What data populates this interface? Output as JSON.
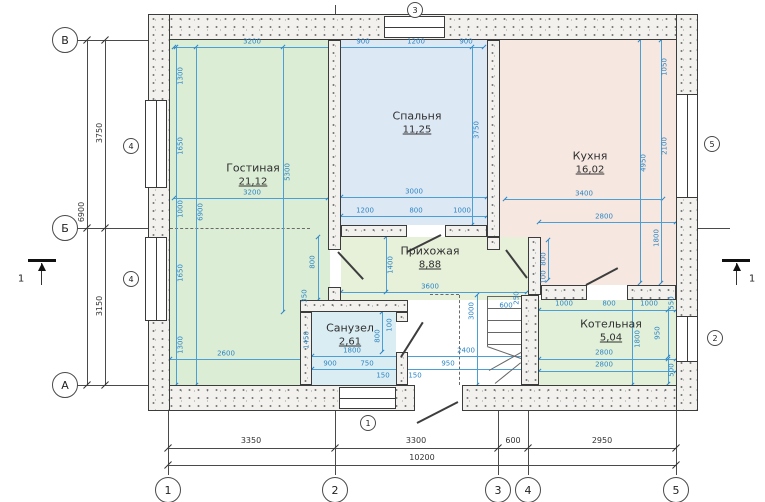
{
  "title": "floor-plan",
  "palette": {
    "dim_blue": "#2e86c4",
    "line_blue": "#4b9fd4",
    "ink": "#3a3a3a",
    "wall_fill": "#f2f1ed",
    "living": "#dcedd6",
    "bedroom": "#dde8f5",
    "kitchen": "#f6e7e0",
    "hall": "#e7f0d9",
    "bath": "#daedf3",
    "boiler": "#e2f0da"
  },
  "rooms": [
    {
      "id": "gostinaya",
      "name": "Гостиная",
      "area": "21,12",
      "color": "#dcedd6",
      "x": 170,
      "y": 40,
      "w": 160,
      "h": 345,
      "lx": 253,
      "ly": 168
    },
    {
      "id": "spalnya",
      "name": "Спальня",
      "area": "11,25",
      "color": "#dde8f5",
      "x": 341,
      "y": 40,
      "w": 146,
      "h": 185,
      "lx": 417,
      "ly": 116
    },
    {
      "id": "kuhnya",
      "name": "Кухня",
      "area": "16,02",
      "color": "#f6e7e0",
      "x": 500,
      "y": 40,
      "w": 176,
      "h": 245,
      "lx": 590,
      "ly": 156
    },
    {
      "id": "prihozhaya",
      "name": "Прихожая",
      "area": "8,88",
      "color": "#e7f0d9",
      "x": 341,
      "y": 237,
      "w": 187,
      "h": 63,
      "lx": 430,
      "ly": 251
    },
    {
      "id": "sanuzel",
      "name": "Санузел",
      "area": "2,61",
      "color": "#daedf3",
      "x": 312,
      "y": 312,
      "w": 84,
      "h": 73,
      "lx": 350,
      "ly": 328
    },
    {
      "id": "kotelnaya",
      "name": "Котельная",
      "area": "5,04",
      "color": "#e2f0da",
      "x": 539,
      "y": 300,
      "w": 137,
      "h": 85,
      "lx": 611,
      "ly": 324
    }
  ],
  "walls": [
    {
      "x": 148,
      "y": 14,
      "w": 550,
      "h": 26
    },
    {
      "x": 148,
      "y": 385,
      "w": 267,
      "h": 26
    },
    {
      "x": 462,
      "y": 385,
      "w": 236,
      "h": 26
    },
    {
      "x": 148,
      "y": 14,
      "w": 22,
      "h": 397
    },
    {
      "x": 676,
      "y": 14,
      "w": 22,
      "h": 397
    },
    {
      "x": 328,
      "y": 40,
      "w": 13,
      "h": 210
    },
    {
      "x": 328,
      "y": 287,
      "w": 13,
      "h": 25
    },
    {
      "x": 341,
      "y": 225,
      "w": 66,
      "h": 12
    },
    {
      "x": 445,
      "y": 225,
      "w": 42,
      "h": 12
    },
    {
      "x": 487,
      "y": 40,
      "w": 13,
      "h": 197
    },
    {
      "x": 487,
      "y": 237,
      "w": 13,
      "h": 13
    },
    {
      "x": 528,
      "y": 237,
      "w": 13,
      "h": 58
    },
    {
      "x": 541,
      "y": 285,
      "w": 46,
      "h": 15
    },
    {
      "x": 627,
      "y": 285,
      "w": 49,
      "h": 15
    },
    {
      "x": 300,
      "y": 300,
      "w": 108,
      "h": 12
    },
    {
      "x": 300,
      "y": 312,
      "w": 12,
      "h": 73
    },
    {
      "x": 396,
      "y": 312,
      "w": 12,
      "h": 10
    },
    {
      "x": 396,
      "y": 352,
      "w": 12,
      "h": 33
    },
    {
      "x": 521,
      "y": 295,
      "w": 18,
      "h": 90
    }
  ],
  "windows": [
    {
      "x": 145,
      "y": 100,
      "w": 22,
      "h": 88,
      "o": "v"
    },
    {
      "x": 145,
      "y": 237,
      "w": 22,
      "h": 84,
      "o": "v"
    },
    {
      "x": 676,
      "y": 94,
      "w": 22,
      "h": 104,
      "o": "v"
    },
    {
      "x": 676,
      "y": 316,
      "w": 22,
      "h": 46,
      "o": "v"
    },
    {
      "x": 384,
      "y": 16,
      "w": 61,
      "h": 22,
      "o": "h"
    },
    {
      "x": 339,
      "y": 387,
      "w": 57,
      "h": 22,
      "o": "h"
    }
  ],
  "window_marks": [
    {
      "label": "4",
      "x": 131,
      "y": 146
    },
    {
      "label": "4",
      "x": 131,
      "y": 279
    },
    {
      "label": "5",
      "x": 712,
      "y": 144
    },
    {
      "label": "2",
      "x": 715,
      "y": 338
    },
    {
      "label": "3",
      "x": 415,
      "y": 10
    },
    {
      "label": "1",
      "x": 368,
      "y": 423
    }
  ],
  "doors": [
    {
      "x1": 338,
      "y1": 251,
      "x2": 363,
      "y2": 278
    },
    {
      "x1": 407,
      "y1": 251,
      "x2": 441,
      "y2": 234
    },
    {
      "x1": 506,
      "y1": 249,
      "x2": 527,
      "y2": 277
    },
    {
      "x1": 586,
      "y1": 284,
      "x2": 618,
      "y2": 267
    },
    {
      "x1": 401,
      "y1": 356,
      "x2": 423,
      "y2": 321
    },
    {
      "x1": 417,
      "y1": 422,
      "x2": 458,
      "y2": 401
    }
  ],
  "stair_treads": [
    {
      "x": 487,
      "y": 296,
      "w": 34,
      "h": 1
    },
    {
      "x": 487,
      "y": 308,
      "w": 34,
      "h": 1
    },
    {
      "x": 487,
      "y": 320,
      "w": 34,
      "h": 1
    },
    {
      "x": 487,
      "y": 332,
      "w": 34,
      "h": 1
    },
    {
      "x": 487,
      "y": 344,
      "w": 34,
      "h": 1
    },
    {
      "x": 487,
      "y": 296,
      "w": 1,
      "h": 50
    }
  ],
  "stair_diagonals": [
    {
      "x1": 487,
      "y1": 346,
      "x2": 521,
      "y2": 358
    },
    {
      "x1": 489,
      "y1": 370,
      "x2": 521,
      "y2": 352
    },
    {
      "x1": 495,
      "y1": 383,
      "x2": 521,
      "y2": 362
    }
  ],
  "dashed": [
    {
      "x": 459,
      "y": 295,
      "w": 1,
      "h": 90,
      "o": "v"
    },
    {
      "x": 430,
      "y": 294,
      "w": 29,
      "h": 1,
      "o": "h"
    },
    {
      "x": 170,
      "y": 228,
      "w": 140,
      "h": 1,
      "o": "h"
    }
  ],
  "blue_lines": [
    {
      "x": 174,
      "y": 47,
      "w": 310,
      "h": 1
    },
    {
      "x": 174,
      "y": 198,
      "w": 154,
      "h": 1
    },
    {
      "x": 341,
      "y": 197,
      "w": 146,
      "h": 1
    },
    {
      "x": 341,
      "y": 216,
      "w": 146,
      "h": 1
    },
    {
      "x": 505,
      "y": 199,
      "w": 158,
      "h": 1
    },
    {
      "x": 539,
      "y": 222,
      "w": 137,
      "h": 1
    },
    {
      "x": 341,
      "y": 292,
      "w": 186,
      "h": 1
    },
    {
      "x": 170,
      "y": 359,
      "w": 133,
      "h": 1
    },
    {
      "x": 312,
      "y": 356,
      "w": 216,
      "h": 1
    },
    {
      "x": 312,
      "y": 369,
      "w": 216,
      "h": 1
    },
    {
      "x": 539,
      "y": 310,
      "w": 137,
      "h": 1
    },
    {
      "x": 539,
      "y": 359,
      "w": 137,
      "h": 1
    },
    {
      "x": 539,
      "y": 371,
      "w": 137,
      "h": 1
    },
    {
      "x": 176,
      "y": 47,
      "w": 1,
      "h": 338
    },
    {
      "x": 196,
      "y": 47,
      "w": 1,
      "h": 338
    },
    {
      "x": 283,
      "y": 47,
      "w": 1,
      "h": 265
    },
    {
      "x": 472,
      "y": 47,
      "w": 1,
      "h": 178
    },
    {
      "x": 640,
      "y": 40,
      "w": 1,
      "h": 243
    },
    {
      "x": 661,
      "y": 40,
      "w": 1,
      "h": 243
    },
    {
      "x": 386,
      "y": 237,
      "w": 1,
      "h": 55
    },
    {
      "x": 318,
      "y": 237,
      "w": 1,
      "h": 63
    },
    {
      "x": 477,
      "y": 295,
      "w": 1,
      "h": 90
    },
    {
      "x": 632,
      "y": 295,
      "w": 1,
      "h": 90
    },
    {
      "x": 668,
      "y": 310,
      "w": 1,
      "h": 47
    },
    {
      "x": 668,
      "y": 359,
      "w": 1,
      "h": 25
    },
    {
      "x": 548,
      "y": 240,
      "w": 1,
      "h": 40
    },
    {
      "x": 382,
      "y": 312,
      "w": 1,
      "h": 40
    }
  ],
  "blue_dims": [
    {
      "v": "3200",
      "x": 252,
      "y": 42
    },
    {
      "v": "900",
      "x": 363,
      "y": 42
    },
    {
      "v": "1200",
      "x": 416,
      "y": 42
    },
    {
      "v": "900",
      "x": 466,
      "y": 42
    },
    {
      "v": "1300",
      "x": 181,
      "y": 76,
      "r": 1
    },
    {
      "v": "1650",
      "x": 181,
      "y": 146,
      "r": 1
    },
    {
      "v": "1000",
      "x": 181,
      "y": 209,
      "r": 1
    },
    {
      "v": "1650",
      "x": 181,
      "y": 273,
      "r": 1
    },
    {
      "v": "1300",
      "x": 181,
      "y": 345,
      "r": 1
    },
    {
      "v": "6900",
      "x": 201,
      "y": 212,
      "r": 1
    },
    {
      "v": "5300",
      "x": 288,
      "y": 172,
      "r": 1
    },
    {
      "v": "3200",
      "x": 252,
      "y": 193
    },
    {
      "v": "2600",
      "x": 226,
      "y": 354
    },
    {
      "v": "3000",
      "x": 414,
      "y": 192
    },
    {
      "v": "1200",
      "x": 365,
      "y": 211
    },
    {
      "v": "800",
      "x": 416,
      "y": 211
    },
    {
      "v": "1000",
      "x": 462,
      "y": 211
    },
    {
      "v": "3750",
      "x": 477,
      "y": 130,
      "r": 1
    },
    {
      "v": "1050",
      "x": 665,
      "y": 67,
      "r": 1
    },
    {
      "v": "2100",
      "x": 665,
      "y": 146,
      "r": 1
    },
    {
      "v": "4950",
      "x": 644,
      "y": 163,
      "r": 1
    },
    {
      "v": "1800",
      "x": 657,
      "y": 238,
      "r": 1
    },
    {
      "v": "3400",
      "x": 584,
      "y": 194
    },
    {
      "v": "2800",
      "x": 604,
      "y": 217
    },
    {
      "v": "1400",
      "x": 391,
      "y": 265,
      "r": 1
    },
    {
      "v": "3600",
      "x": 430,
      "y": 287
    },
    {
      "v": "800",
      "x": 313,
      "y": 262,
      "r": 1
    },
    {
      "v": "350",
      "x": 305,
      "y": 296,
      "r": 1
    },
    {
      "v": "250",
      "x": 517,
      "y": 298,
      "r": 1
    },
    {
      "v": "600",
      "x": 506,
      "y": 306
    },
    {
      "v": "3000",
      "x": 472,
      "y": 311,
      "r": 1
    },
    {
      "v": "800",
      "x": 544,
      "y": 259,
      "r": 1
    },
    {
      "v": "100",
      "x": 544,
      "y": 277,
      "r": 1
    },
    {
      "v": "1450",
      "x": 307,
      "y": 340,
      "r": 1
    },
    {
      "v": "1800",
      "x": 352,
      "y": 351
    },
    {
      "v": "800",
      "x": 378,
      "y": 336,
      "r": 1
    },
    {
      "v": "100",
      "x": 390,
      "y": 325,
      "r": 1
    },
    {
      "v": "900",
      "x": 330,
      "y": 364
    },
    {
      "v": "750",
      "x": 367,
      "y": 364
    },
    {
      "v": "150",
      "x": 383,
      "y": 376
    },
    {
      "v": "150",
      "x": 415,
      "y": 376
    },
    {
      "v": "950",
      "x": 448,
      "y": 364
    },
    {
      "v": "2400",
      "x": 466,
      "y": 351
    },
    {
      "v": "1000",
      "x": 564,
      "y": 304
    },
    {
      "v": "800",
      "x": 609,
      "y": 304
    },
    {
      "v": "1000",
      "x": 649,
      "y": 304
    },
    {
      "v": "550",
      "x": 672,
      "y": 303,
      "r": 1
    },
    {
      "v": "950",
      "x": 658,
      "y": 333,
      "r": 1
    },
    {
      "v": "1800",
      "x": 638,
      "y": 339,
      "r": 1
    },
    {
      "v": "2800",
      "x": 604,
      "y": 353
    },
    {
      "v": "2800",
      "x": 604,
      "y": 365
    },
    {
      "v": "500",
      "x": 672,
      "y": 370,
      "r": 1
    }
  ],
  "black_lines": [
    {
      "x": 87,
      "y": 40,
      "w": 1,
      "h": 345
    },
    {
      "x": 105,
      "y": 40,
      "w": 1,
      "h": 345
    },
    {
      "x": 168,
      "y": 448,
      "w": 508,
      "h": 1
    },
    {
      "x": 168,
      "y": 465,
      "w": 508,
      "h": 1
    },
    {
      "x": 76,
      "y": 40,
      "w": 72,
      "h": 1
    },
    {
      "x": 76,
      "y": 228,
      "w": 72,
      "h": 1
    },
    {
      "x": 76,
      "y": 385,
      "w": 72,
      "h": 1
    },
    {
      "x": 698,
      "y": 228,
      "w": 32,
      "h": 1
    },
    {
      "x": 168,
      "y": 411,
      "w": 1,
      "h": 64
    },
    {
      "x": 335,
      "y": 411,
      "w": 1,
      "h": 64
    },
    {
      "x": 498,
      "y": 411,
      "w": 1,
      "h": 64
    },
    {
      "x": 528,
      "y": 411,
      "w": 1,
      "h": 64
    },
    {
      "x": 676,
      "y": 411,
      "w": 1,
      "h": 64
    },
    {
      "x": 335,
      "y": 5,
      "w": 1,
      "h": 33
    },
    {
      "x": 498,
      "y": 22,
      "w": 1,
      "h": 16
    }
  ],
  "black_dims": [
    {
      "v": "3750",
      "x": 100,
      "y": 133,
      "r": 1
    },
    {
      "v": "3150",
      "x": 100,
      "y": 306,
      "r": 1
    },
    {
      "v": "6900",
      "x": 82,
      "y": 212,
      "r": 1
    },
    {
      "v": "3350",
      "x": 251,
      "y": 441
    },
    {
      "v": "3300",
      "x": 416,
      "y": 441
    },
    {
      "v": "600",
      "x": 513,
      "y": 441
    },
    {
      "v": "2950",
      "x": 602,
      "y": 441
    },
    {
      "v": "10200",
      "x": 422,
      "y": 458
    }
  ],
  "black_ticks": [
    {
      "x": 87,
      "y": 40
    },
    {
      "x": 87,
      "y": 228
    },
    {
      "x": 87,
      "y": 385
    },
    {
      "x": 105,
      "y": 40
    },
    {
      "x": 105,
      "y": 228
    },
    {
      "x": 105,
      "y": 385
    },
    {
      "x": 168,
      "y": 448
    },
    {
      "x": 335,
      "y": 448
    },
    {
      "x": 498,
      "y": 448
    },
    {
      "x": 528,
      "y": 448
    },
    {
      "x": 676,
      "y": 448
    },
    {
      "x": 168,
      "y": 465
    },
    {
      "x": 676,
      "y": 465
    }
  ],
  "axis_circles": [
    {
      "label": "В",
      "x": 65,
      "y": 40,
      "d": 26
    },
    {
      "label": "Б",
      "x": 65,
      "y": 228,
      "d": 26
    },
    {
      "label": "А",
      "x": 65,
      "y": 385,
      "d": 26
    },
    {
      "label": "1",
      "x": 168,
      "y": 490,
      "d": 26
    },
    {
      "label": "2",
      "x": 335,
      "y": 490,
      "d": 26
    },
    {
      "label": "3",
      "x": 498,
      "y": 490,
      "d": 26
    },
    {
      "label": "4",
      "x": 528,
      "y": 490,
      "d": 26
    },
    {
      "label": "5",
      "x": 676,
      "y": 490,
      "d": 26
    }
  ],
  "section_marks": [
    {
      "label": "1",
      "bar": {
        "x": 28,
        "y": 259,
        "w": 28,
        "h": 3
      },
      "stem": {
        "x": 41,
        "y": 263,
        "h": 22
      },
      "lx": 21,
      "ly": 279
    },
    {
      "label": "1",
      "bar": {
        "x": 722,
        "y": 259,
        "w": 28,
        "h": 3
      },
      "stem": {
        "x": 736,
        "y": 263,
        "h": 22
      },
      "lx": 752,
      "ly": 279
    }
  ]
}
